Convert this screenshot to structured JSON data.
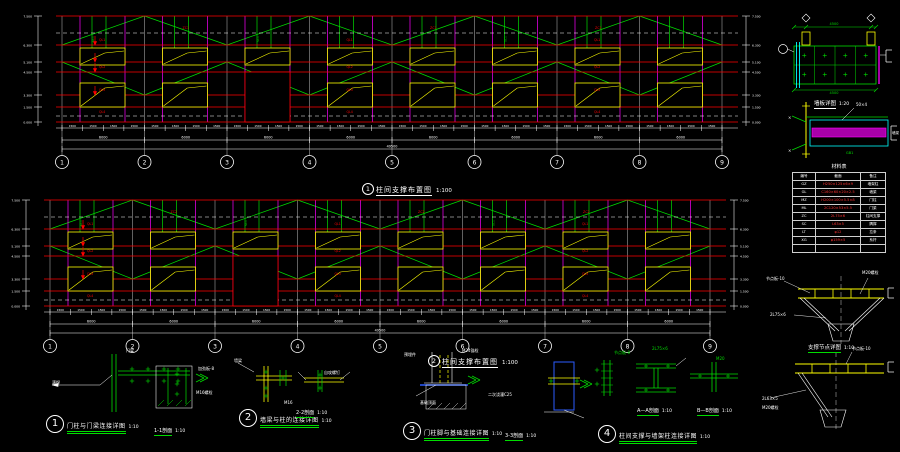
{
  "palette": {
    "red": "#ff0000",
    "green": "#00dd00",
    "magenta": "#ff00ff",
    "yellow": "#ffff00",
    "cyan": "#00ffff",
    "white": "#ffffff",
    "blue": "#2b5cff",
    "magfill": "#aa00aa"
  },
  "elevations": [
    {
      "number": "1",
      "title": "柱间支撑布置图",
      "scale": "1:100",
      "grid_labels": [
        "1",
        "2",
        "3",
        "4",
        "5",
        "6",
        "7",
        "8",
        "9"
      ],
      "levels": [
        "7.500",
        "6.300",
        "5.100",
        "4.500",
        "3.300",
        "1.500",
        "0.000"
      ],
      "girt_tags": [
        "QL1",
        "QL2",
        "QL3",
        "QL4"
      ],
      "brace_tag": "ZC1",
      "rod_tag": "SC1",
      "dims": {
        "small": "1500",
        "bay": "6000",
        "total": "49500"
      }
    },
    {
      "number": "2",
      "title": "柱间支撑布置图",
      "scale": "1:100",
      "grid_labels": [
        "1",
        "2",
        "3",
        "4",
        "5",
        "6",
        "7",
        "8",
        "9"
      ],
      "levels": [
        "7.500",
        "6.300",
        "5.100",
        "4.500",
        "3.300",
        "1.500",
        "0.000"
      ],
      "girt_tags": [
        "QL1",
        "QL2",
        "QL3",
        "QL4"
      ],
      "brace_tag": "ZC2",
      "rod_tag": "SC1",
      "dims": {
        "small": "1500",
        "bay": "6000",
        "total": "49500"
      }
    }
  ],
  "details": [
    {
      "number": "1",
      "title": "门柱与门梁连接详图",
      "scale": "1:10",
      "sections": [
        {
          "label": "1-1剖面",
          "scale": "1:10"
        }
      ]
    },
    {
      "number": "2",
      "title": "墙梁与柱的连接详图",
      "scale": "1:10",
      "sections": [
        {
          "label": "2-2剖面",
          "scale": "1:10"
        }
      ]
    },
    {
      "number": "3",
      "title": "门柱脚与基础连接详图",
      "scale": "1:10",
      "sections": [
        {
          "label": "3-3剖面",
          "scale": "1:10"
        }
      ]
    },
    {
      "number": "4",
      "title": "柱间支撑与墙架柱连接详图",
      "scale": "1:10",
      "sections": [
        {
          "label": "A—A剖面",
          "scale": "1:10"
        },
        {
          "label": "B—B剖面",
          "scale": "1:10"
        }
      ]
    }
  ],
  "right_panel": {
    "wall_panel_detail": {
      "title": "墙板详图",
      "scale": "1:20"
    },
    "node_detail_title": "支撑节点详图",
    "node_detail_scale": "1:10",
    "table": {
      "title": "材料表",
      "headers": [
        "编号",
        "截面",
        "备注"
      ],
      "rows": [
        [
          "GZ",
          "H250×125×6×9",
          "墙架柱"
        ],
        [
          "GL",
          "C160×60×20×2.5",
          "墙梁"
        ],
        [
          "MZ",
          "H200×100×5.5×8",
          "门柱"
        ],
        [
          "ML",
          "2C120×53×5.5",
          "门梁"
        ],
        [
          "ZC",
          "2L75×6",
          "柱间支撑"
        ],
        [
          "SC",
          "L63×5",
          "隅撑"
        ],
        [
          "LT",
          "φ12",
          "拉条"
        ],
        [
          "XG",
          "φ159×5",
          "系杆"
        ],
        [
          "",
          "",
          ""
        ]
      ]
    }
  },
  "annotations": [
    {
      "t": "满焊",
      "x": 52,
      "y": 384
    },
    {
      "t": "门梁",
      "x": 126,
      "y": 352
    },
    {
      "t": "M16螺栓",
      "x": 196,
      "y": 394
    },
    {
      "t": "加劲板-8",
      "x": 198,
      "y": 370
    },
    {
      "t": "墙梁",
      "x": 234,
      "y": 362
    },
    {
      "t": "自攻螺钉",
      "x": 324,
      "y": 374
    },
    {
      "t": "M16",
      "x": 284,
      "y": 404
    },
    {
      "t": "预埋件",
      "x": 404,
      "y": 356
    },
    {
      "t": "M24锚栓",
      "x": 462,
      "y": 352
    },
    {
      "t": "二次浇灌C25",
      "x": 488,
      "y": 396
    },
    {
      "t": "基础顶面",
      "x": 420,
      "y": 404
    },
    {
      "t": "节点板-8",
      "x": 614,
      "y": 354,
      "c": "green"
    },
    {
      "t": "2L75×6",
      "x": 652,
      "y": 350,
      "c": "green"
    },
    {
      "t": "M20",
      "x": 716,
      "y": 360,
      "c": "green"
    },
    {
      "t": "4500",
      "x": 834,
      "y": 25,
      "c": "green",
      "s": 3.5,
      "a": "middle"
    },
    {
      "t": "4500",
      "x": 834,
      "y": 94,
      "c": "green",
      "s": 3.5,
      "a": "middle"
    },
    {
      "t": "50×4",
      "x": 856,
      "y": 106
    },
    {
      "t": "墙梁",
      "x": 892,
      "y": 134,
      "s": 3.5
    },
    {
      "t": "GB1",
      "x": 846,
      "y": 154,
      "c": "green",
      "s": 3.5
    },
    {
      "t": "节点板-10",
      "x": 766,
      "y": 280
    },
    {
      "t": "M20螺栓",
      "x": 862,
      "y": 274
    },
    {
      "t": "2L75×6",
      "x": 770,
      "y": 316
    },
    {
      "t": "节点板-10",
      "x": 852,
      "y": 350
    },
    {
      "t": "2L63×5",
      "x": 762,
      "y": 400
    },
    {
      "t": "M20螺栓",
      "x": 762,
      "y": 409
    }
  ]
}
